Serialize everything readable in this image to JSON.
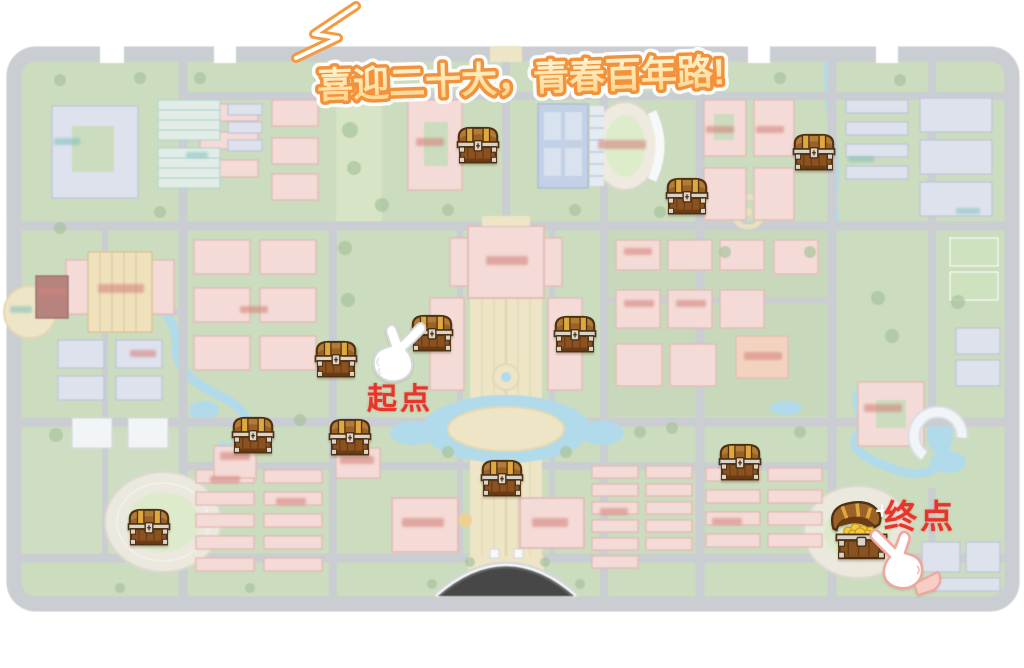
{
  "banner": {
    "text": "喜迎二十大，青春百年路!",
    "fill_top": "#fff6d6",
    "fill_bottom": "#ffd387",
    "outline_color": "#f2923c"
  },
  "overlay": {
    "start": {
      "label": "起点",
      "x": 400,
      "y": 396
    },
    "end": {
      "label": "终点",
      "x": 920,
      "y": 514
    },
    "label_color": "#e8352b",
    "chests": [
      {
        "x": 478,
        "y": 144,
        "state": "closed"
      },
      {
        "x": 687,
        "y": 195,
        "state": "closed"
      },
      {
        "x": 814,
        "y": 151,
        "state": "closed"
      },
      {
        "x": 432,
        "y": 332,
        "state": "closed"
      },
      {
        "x": 575,
        "y": 333,
        "state": "closed"
      },
      {
        "x": 336,
        "y": 358,
        "state": "closed"
      },
      {
        "x": 253,
        "y": 434,
        "state": "closed"
      },
      {
        "x": 350,
        "y": 436,
        "state": "closed"
      },
      {
        "x": 502,
        "y": 477,
        "state": "closed"
      },
      {
        "x": 740,
        "y": 461,
        "state": "closed"
      },
      {
        "x": 149,
        "y": 526,
        "state": "closed"
      },
      {
        "x": 860,
        "y": 530,
        "state": "open"
      }
    ]
  },
  "icons": {
    "start_hand": "pointing-hand-up-right-icon",
    "end_hand": "pointing-hand-up-left-icon",
    "banner_decoration": "swoosh-emphasis-icon",
    "chest_closed": "treasure-chest-closed-icon",
    "chest_open": "treasure-chest-open-icon"
  },
  "map_palette": {
    "grass": "#b7cfa4",
    "road": "#b6bac0",
    "water": "#8fcfe6",
    "building_pink": "#f4cdc6",
    "building_lavender": "#d2d7e8",
    "boulevard_tan": "#e9dcae",
    "chest_gold": "#f6c83e"
  }
}
